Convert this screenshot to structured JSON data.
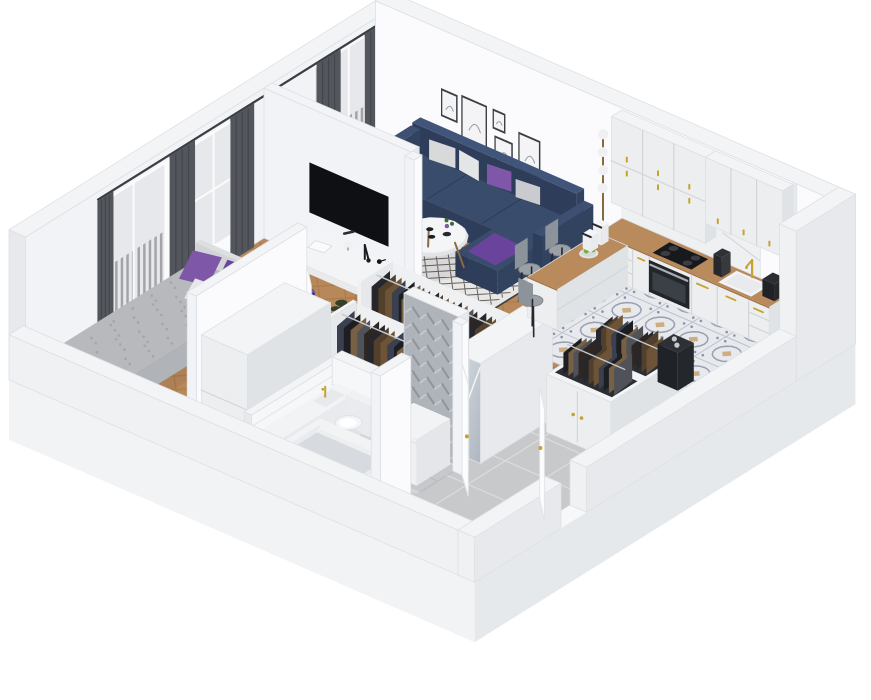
{
  "scene": {
    "description": "3D isometric cutaway rendering of a one-bedroom apartment floor plan, viewed from above the south corner, on a white background",
    "rooms": [
      {
        "id": "living-room",
        "label": "Living room",
        "floor": "herringbone wood"
      },
      {
        "id": "kitchen",
        "label": "Kitchen",
        "floor": "patterned moroccan tile"
      },
      {
        "id": "bedroom",
        "label": "Bedroom",
        "floor": "herringbone wood"
      },
      {
        "id": "wardrobe-corridor",
        "label": "Wardrobe corridor",
        "floor": "herringbone wood"
      },
      {
        "id": "bathroom",
        "label": "Bathroom",
        "floor": "gray tile"
      },
      {
        "id": "hallway",
        "label": "Entry hallway",
        "floor": "large gray tile"
      }
    ],
    "furniture": [
      {
        "id": "sofa",
        "label": "Navy corner sofa with gray and purple pillows"
      },
      {
        "id": "coffee-table",
        "label": "Round white coffee table"
      },
      {
        "id": "living-rug",
        "label": "Black and white diamond rug"
      },
      {
        "id": "floor-lamp",
        "label": "Brass floor lamp with white globes"
      },
      {
        "id": "wall-art",
        "label": "Gallery of five line-art frames"
      },
      {
        "id": "tv",
        "label": "Wall mounted TV"
      },
      {
        "id": "kitchen-counter",
        "label": "White kitchen cabinets with wood counter"
      },
      {
        "id": "kitchen-upper-cabinets",
        "label": "White upper cabinets with gold handles"
      },
      {
        "id": "cooktop",
        "label": "Black cooktop"
      },
      {
        "id": "oven",
        "label": "Built-in oven"
      },
      {
        "id": "sink",
        "label": "White sink with gold faucet"
      },
      {
        "id": "peninsula",
        "label": "Kitchen peninsula with fruit bowl"
      },
      {
        "id": "bar-chairs",
        "label": "Gray bar chairs"
      },
      {
        "id": "bed",
        "label": "Bed with gray duvet and purple pillows"
      },
      {
        "id": "desk",
        "label": "White desk with lamps"
      },
      {
        "id": "desk-chair",
        "label": "Purple shell chair"
      },
      {
        "id": "bedroom-rug",
        "label": "Round gray rug"
      },
      {
        "id": "wardrobe-rack-a",
        "label": "Open wardrobe rack with clothes"
      },
      {
        "id": "wardrobe-rack-b",
        "label": "Open wardrobe rack with clothes"
      },
      {
        "id": "mirror-wardrobe",
        "label": "Mirrored wardrobe"
      },
      {
        "id": "nook-wardrobe",
        "label": "White wardrobe cabinet"
      },
      {
        "id": "hall-cabinet",
        "label": "Hallway wardrobe with hanging clothes"
      },
      {
        "id": "storage-bin",
        "label": "Black storage unit"
      },
      {
        "id": "washing-machine",
        "label": "Washing machine"
      },
      {
        "id": "toilet",
        "label": "Toilet"
      },
      {
        "id": "bathtub",
        "label": "Bathtub with gold tap"
      },
      {
        "id": "vanity",
        "label": "Bathroom vanity with gold tap"
      },
      {
        "id": "bath-mat",
        "label": "Dark gray bath mat"
      },
      {
        "id": "balcony-living",
        "label": "Balcony with dark railing"
      },
      {
        "id": "balcony-bedroom",
        "label": "Balcony with dark railing"
      },
      {
        "id": "utility-shaft",
        "label": "Utility shaft niche"
      },
      {
        "id": "entry-door",
        "label": "Open entry door"
      },
      {
        "id": "bathroom-door",
        "label": "Open bathroom door"
      },
      {
        "id": "bedroom-door",
        "label": "Open bedroom door"
      }
    ],
    "palette": {
      "white": "#ffffff",
      "wallTop": "#f3f4f6",
      "wallInnerBright": "#fbfbfd",
      "wallInnerSoft": "#f1f3f6",
      "wallOuter": "#eff1f3",
      "wallEnd": "#e7e9ed",
      "slabR": "#e6e9ec",
      "slabL": "#f2f3f5",
      "slabTop": "#f7f8fa",
      "stroke": "#dde0e4",
      "woodBase": "#b8885a",
      "woodDark": "#9e6f3e",
      "ktileBase": "#e7e9ed",
      "ktileInk": "#8a93a8",
      "ktileTan": "#c79e66",
      "ktileGrid": "#bcc2cc",
      "htileBase": "#c7c9ca",
      "htileGrout": "#d9dbdb",
      "btileBase": "#d3d6d9",
      "btileGrout": "#c2c5c8",
      "sofaTop": "#3a4c6b",
      "sofaL": "#2e3d59",
      "sofaR": "#32435f",
      "sofaSeam": "#2c3a54",
      "purple": "#7e57a8",
      "purpleD": "#6a449c",
      "cushion1": "#d8d9db",
      "cushion2": "#e4e5e7",
      "cushion3": "#c9cbce",
      "curtain": "#53575d",
      "curtainD": "#43474d",
      "sheer": "rgba(255,255,255,0.55)",
      "glass": "#c8cdd3",
      "railing": "#34373c",
      "frame": "#f5f6f7",
      "counterWood": "#b98a5c",
      "counterEdge": "#a3754a",
      "cabinet": "#eceeef",
      "cabinetShade": "#e0e3e6",
      "cabinetLine": "#d2d6d9",
      "gold": "#c9a22e",
      "marble": "#eef0f2",
      "marbleVein": "#c9ced6",
      "dark": "#17191d",
      "oven": "#22252a",
      "ovenWin": "#3b3f46",
      "steel": "#a8aeb4",
      "tv": "#0e1013",
      "bedDuvet": "#b7b9bc",
      "bedDot": "#a2a5a9",
      "bedFrame": "#e4e5e8",
      "bedSideL": "#aaadb1",
      "bedSideR": "#b0b3b7",
      "headboard": "#dcdee1",
      "mat": "#7e8184",
      "tubInner": "#e9ebee",
      "tubShadow": "#d7dade",
      "mirror1": "#dae0e6",
      "mirror2": "#aeb6bf",
      "plantDark": "#26301f",
      "plantDark2": "#33402a",
      "apple": "#7cae3f",
      "chairGray": "#9aa0a6",
      "chairGrayD": "#82878d",
      "chevBase": "#aeb4b9",
      "chevA": "#c2c7cb",
      "chevB": "#8f959a",
      "subway": "#f6f7f9",
      "subwayLine": "#e2e5e8",
      "rugBase": "#e9e7e3",
      "rugInk": "#3e4145",
      "roundRug": "#d5d6d7",
      "wmDoor": "#22262b",
      "wmRing": "#dfe2e5",
      "wmGlass": "#39557f",
      "leaf": "#fcfdfe",
      "shadow": "rgba(30,35,45,0.07)",
      "clothes": [
        "#26262b",
        "#53402c",
        "#6e5436",
        "#3a4050",
        "#1d1e22",
        "#776044",
        "#50525a",
        "#2e2620"
      ]
    }
  }
}
